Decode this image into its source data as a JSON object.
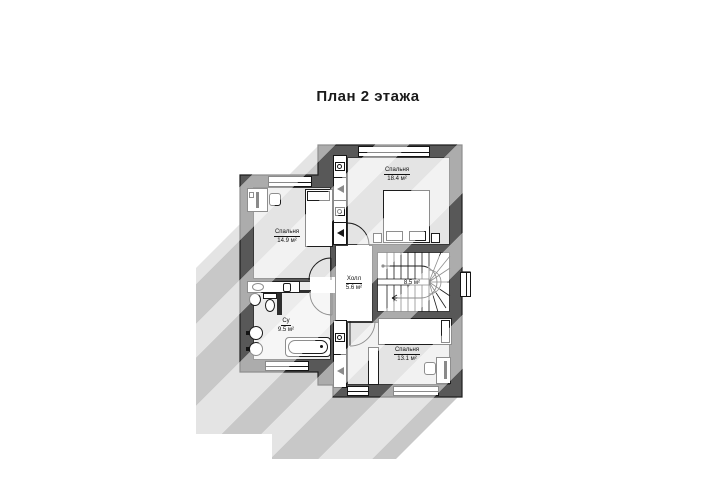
{
  "title": "План 2 этажа",
  "colors": {
    "wall": "#585858",
    "wall_edge": "#1e1e1e",
    "floor": "#e4e4e4",
    "bath_floor": "#ececec",
    "shadow": "#c8c8c8",
    "background": "#ffffff"
  },
  "rooms": [
    {
      "name": "Спальня",
      "area": "14.9 м²"
    },
    {
      "name": "Спальня",
      "area": "18.4 м²"
    },
    {
      "name": "Холл",
      "area": "5.6 м²"
    },
    {
      "name": "",
      "area": "8.5 м²"
    },
    {
      "name": "Су",
      "area": "9.5 м²"
    },
    {
      "name": "Спальня",
      "area": "13.1 м²"
    }
  ]
}
